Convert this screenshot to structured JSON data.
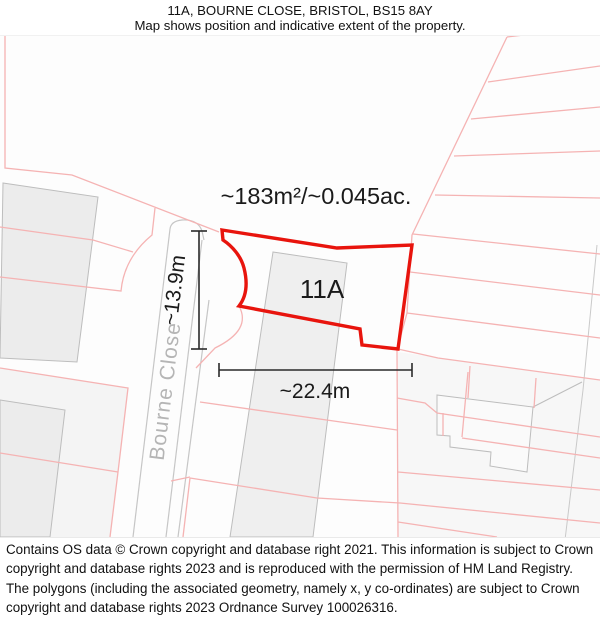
{
  "header": {
    "title": "11A, BOURNE CLOSE, BRISTOL, BS15 8AY",
    "subtitle": "Map shows position and indicative extent of the property."
  },
  "map": {
    "area_label": "~183m²/~0.045ac.",
    "plot_label": "11A",
    "street_label": "Bourne Close",
    "width_label": "~22.4m",
    "height_label": "~13.9m",
    "colors": {
      "property_outline": "#e8140d",
      "parcel_line": "#f5b3b3",
      "road_line": "#c6c6c6",
      "building_fill": "#efefef",
      "building_outline": "#bdbdbd",
      "street_text": "#b5b5b5",
      "measurement_line": "#2a2a2a"
    }
  },
  "footer": {
    "copyright": "Contains OS data © Crown copyright and database right 2021. This information is subject to Crown copyright and database rights 2023 and is reproduced with the permission of HM Land Registry. The polygons (including the associated geometry, namely x, y co-ordinates) are subject to Crown copyright and database rights 2023 Ordnance Survey 100026316."
  }
}
